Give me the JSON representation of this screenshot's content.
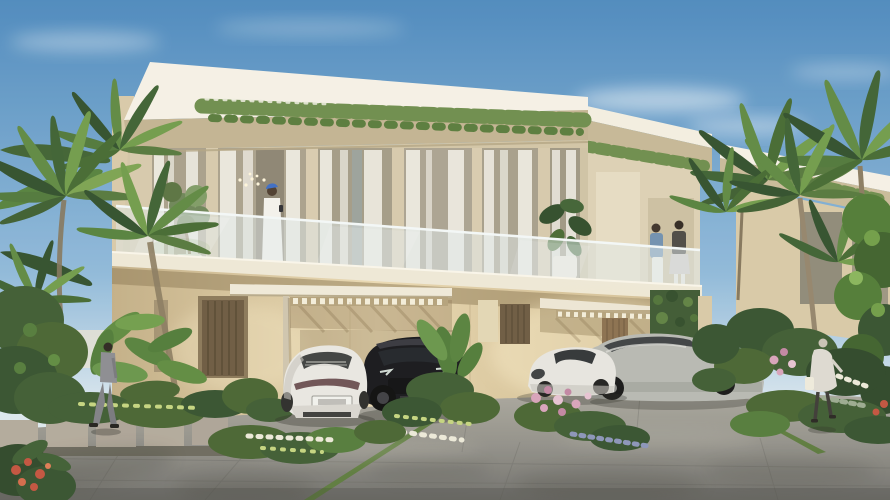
{
  "meta": {
    "kind": "architectural-render",
    "description": "Photoreal exterior render of modern two-storey cream villas with cantilevered roofs, trailing roof vines, glass balcony, carports with four luxury cars, tropical palms and flower beds, and pedestrians on a grey paved driveway under a blue sky."
  },
  "colors": {
    "sky_top": "#4b88bd",
    "sky_mid": "#8fb9da",
    "sky_horizon": "#dce8ef",
    "cloud": "#ffffff",
    "roof": "#f6f1e6",
    "roof_parapet": "#c2b391",
    "wall_light": "#ead9b2",
    "wall_mid": "#d2bd92",
    "wall_deep": "#c3ae85",
    "pier": "#d6c9ab",
    "glass_interior": "#a39a85",
    "curtain": "#f1eee6",
    "balustrade": "#e2ecee",
    "slab": "#efe8d6",
    "vine_green": "#6c8c4a",
    "palm_dark": "#2f4d2a",
    "palm_mid": "#4e7638",
    "palm_light": "#7ba24e",
    "garden_dark": "#3c5730",
    "garden_mid": "#527a38",
    "flower_pink": "#d8a2ba",
    "flower_white": "#ece9d9",
    "flower_red": "#c2513b",
    "drive_light": "#aaa79d",
    "drive_mid": "#918f88",
    "drive_dark": "#6f6e6a",
    "grass_strip": "#5b7a3b",
    "path_slab": "#b2a99a",
    "door_bronze": "#6b583f",
    "door_wood": "#8a6e4c",
    "green_wall": "#3c5730",
    "robe_white": "#f4f2ec",
    "cap_blue": "#3a6bc4",
    "suit_grey": "#8b8b90",
    "coat_light": "#dedad1"
  },
  "scene": {
    "sky": {
      "cloud_count": 5
    },
    "buildings": [
      {
        "name": "main-villa",
        "storeys": 2,
        "features": [
          "cantilevered flat roof",
          "trailing vines on roof edge",
          "glass balustrade balcony",
          "floor-to-ceiling curtained glazing",
          "double carport canopies",
          "bronze louvred doors",
          "dentil trim bands",
          "green wall panel"
        ]
      },
      {
        "name": "background-villa",
        "storeys": 2,
        "features": [
          "cantilevered flat roof",
          "trailing vines on roof edge"
        ]
      }
    ],
    "vehicles": [
      {
        "name": "white-fastback-rear",
        "color": "white",
        "color_hex": "#e9e7e2",
        "view": "rear",
        "position": "left carport, left stall"
      },
      {
        "name": "black-suv",
        "color": "black",
        "color_hex": "#141418",
        "view": "front three-quarter",
        "position": "left carport, right stall"
      },
      {
        "name": "white-sports-coupe",
        "color": "white",
        "color_hex": "#e7e5e0",
        "view": "front three-quarter",
        "position": "right driveway, foreground"
      },
      {
        "name": "silver-suv",
        "color": "silver grey",
        "color_hex": "#b7b8b2",
        "view": "front three-quarter",
        "position": "right carport"
      }
    ],
    "people": [
      {
        "name": "balcony-man",
        "outfit": "white robe with blue cap",
        "activity": "looking at phone on balcony"
      },
      {
        "name": "balcony-woman-1",
        "outfit": "blue top, white trousers",
        "activity": "talking on balcony"
      },
      {
        "name": "balcony-woman-2",
        "outfit": "dark top, light skirt",
        "activity": "talking on balcony"
      },
      {
        "name": "path-man",
        "outfit": "grey suit",
        "activity": "walking on stepping-stone path"
      },
      {
        "name": "walkway-woman",
        "outfit": "light coat, dark trousers, tote bag",
        "activity": "walking past flower bed"
      }
    ],
    "vegetation": [
      "fan palms left",
      "fan palms right",
      "palms between villas",
      "banana plants",
      "clipped hedge",
      "pink / white / red flower beds",
      "roofline trailing vines",
      "green wall panel"
    ],
    "ground": [
      "stepping-stone path",
      "concrete paver driveway",
      "grass strips between slabs",
      "dappled tree shadows"
    ]
  }
}
